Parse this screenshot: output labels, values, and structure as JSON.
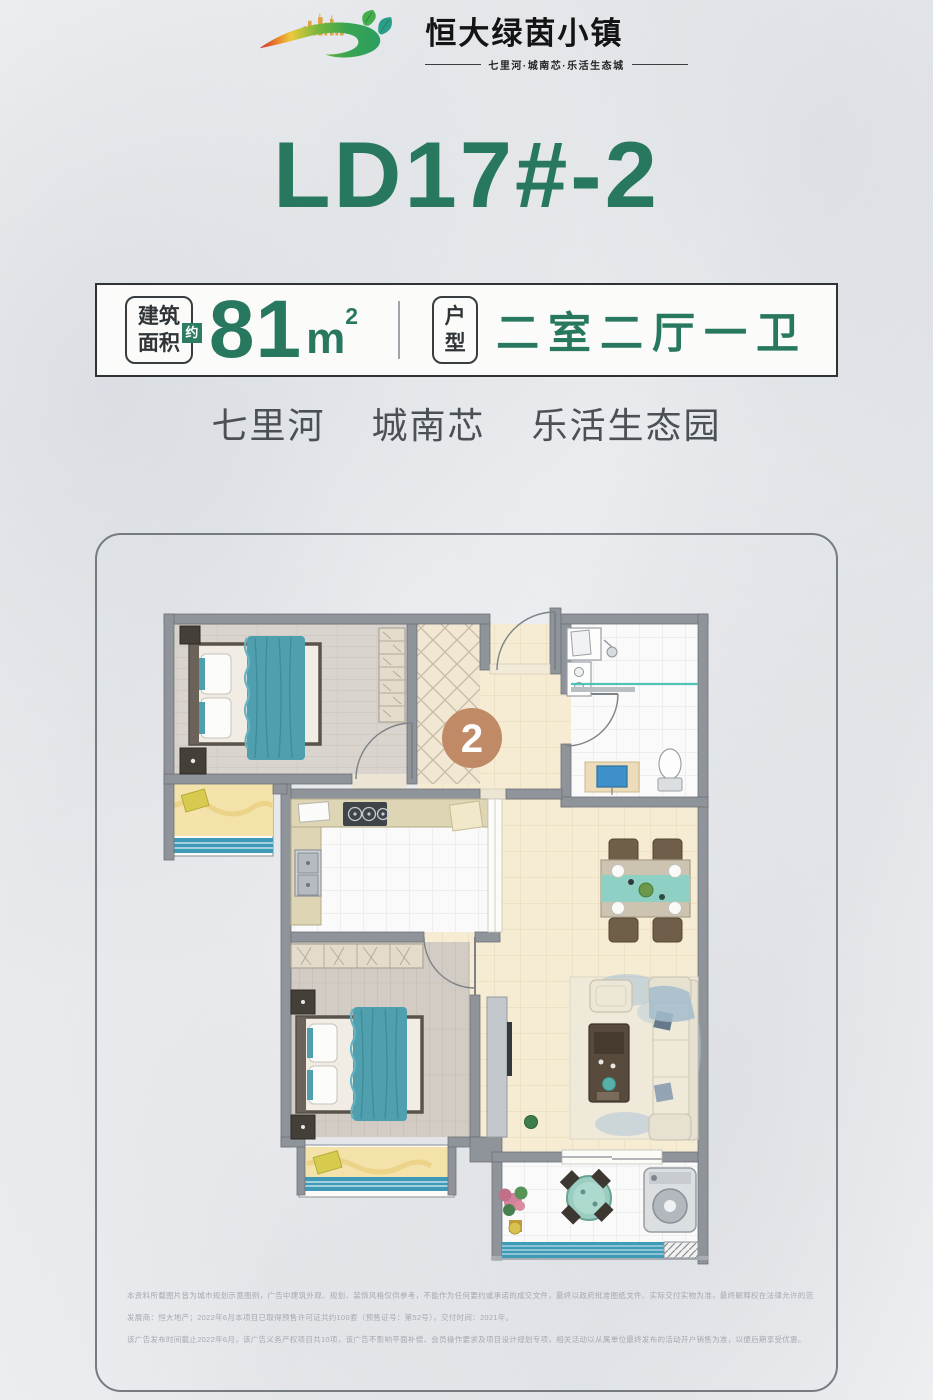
{
  "brand": {
    "name": "恒大绿茵小镇",
    "tagline": "七里河·城南芯·乐活生态城"
  },
  "title": "LD17#-2",
  "spec": {
    "area_label": [
      "建筑",
      "面积"
    ],
    "approx": "约",
    "area_value": "81",
    "area_unit_base": "m",
    "area_unit_exp": "2",
    "type_label": [
      "户",
      "型"
    ],
    "type_value": "二室二厅一卫"
  },
  "subtitle": {
    "items": [
      "七里河",
      "城南芯",
      "乐活生态园"
    ]
  },
  "floorplan": {
    "badge": "2"
  },
  "disclaimer": {
    "lines": [
      "本资料所载图片皆为城市规划示意图例，广告中建筑外观、规划、装饰风格仅供参考，不能作为任何要约或承诺的成交文件，最终以政府批准图纸文件、实际交付实物为准，最终解释权在法律允许的范围内归出卖人所有。",
      "发展商：恒大地产；2022年6月本项目已取得预售许可证共约100套（预售证号：第52号），交付时间：2021年。",
      "该广告发布时间截止2022年6月，该广告义务产权项目共10项，该广告不影响平面补偿、会员操作要求及项目设计规划专项，相关活动以从属单位最终发布的活动开户销售为准，以便后期享受优惠。"
    ]
  },
  "colors": {
    "accent_green": "#27785f",
    "badge_tan": "#c08a66",
    "teal": "#4f9fae",
    "wall_gray": "#8f949a"
  }
}
